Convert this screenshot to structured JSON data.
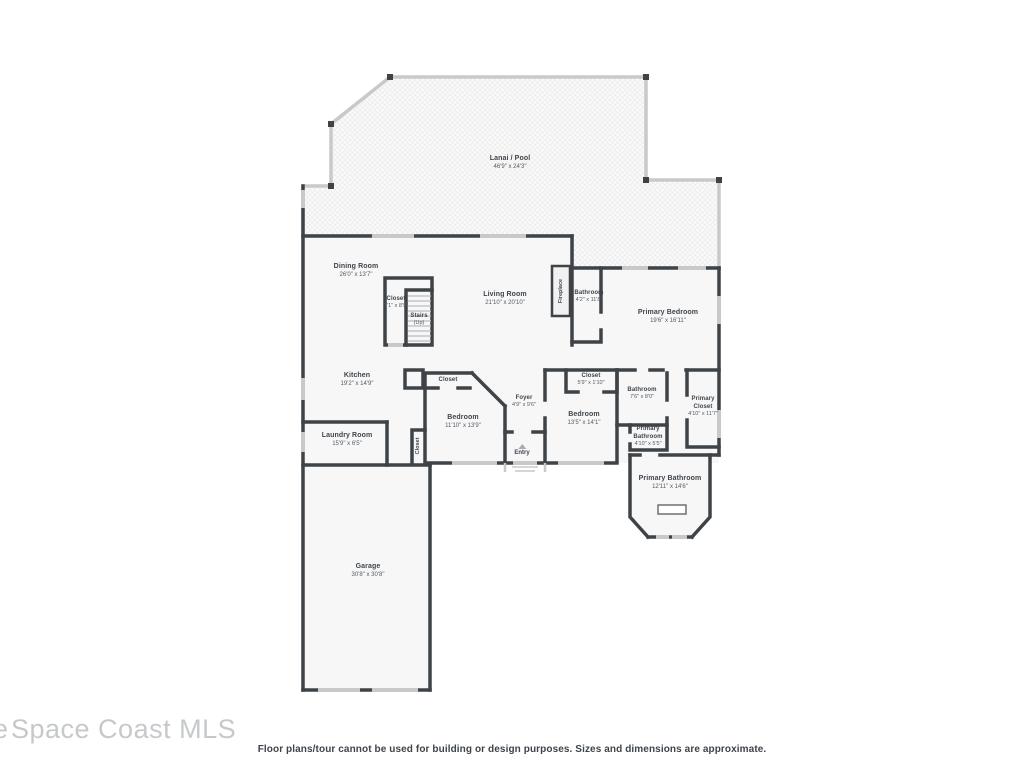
{
  "page": {
    "watermark": "Space Coast MLS",
    "watermark_partial": "e",
    "disclaimer": "Floor plans/tour cannot be used for building or design purposes. Sizes and dimensions are approximate."
  },
  "rooms": {
    "lanai": {
      "label": "Lanai / Pool",
      "dims": "46'9\" x 24'3\""
    },
    "dining": {
      "label": "Dining Room",
      "dims": "26'0\" x 13'7\""
    },
    "living": {
      "label": "Living Room",
      "dims": "21'10\" x 20'10\""
    },
    "closet_stairs": {
      "label": "Closet",
      "dims": "7'1\" x 8'9\""
    },
    "stairs": {
      "label": "Stairs",
      "dims": "(Up)"
    },
    "bath_top": {
      "label": "Bathroom",
      "dims": "4'2\" x 11'8\""
    },
    "primary_bedroom": {
      "label": "Primary Bedroom",
      "dims": "19'6\" x 16'11\""
    },
    "kitchen": {
      "label": "Kitchen",
      "dims": "19'2\" x 14'9\""
    },
    "laundry": {
      "label": "Laundry Room",
      "dims": "15'9\" x 6'5\""
    },
    "bedroom1": {
      "label": "Bedroom",
      "dims": "11'10\" x 13'9\""
    },
    "closet_bed1": {
      "label": "Closet"
    },
    "closet_vert": {
      "label": "Closet"
    },
    "foyer": {
      "label": "Foyer",
      "dims": "4'9\" x 9'6\""
    },
    "entry": {
      "label": "Entry"
    },
    "closet2": {
      "label": "Closet",
      "dims": "5'9\" x 1'10\""
    },
    "bedroom2": {
      "label": "Bedroom",
      "dims": "13'5\" x 14'1\""
    },
    "bathroom2": {
      "label": "Bathroom",
      "dims": "7'6\" x 8'0\""
    },
    "primary_bath_small": {
      "label": "Primary Bathroom",
      "dims": "4'10\" x 5'5\""
    },
    "primary_closet": {
      "label": "Primary Closet",
      "dims": "4'10\" x 11'7\""
    },
    "primary_bath": {
      "label": "Primary Bathroom",
      "dims": "12'11\" x 14'6\""
    },
    "garage": {
      "label": "Garage",
      "dims": "30'8\" x 30'8\""
    },
    "fireplace": {
      "label": "Fireplace"
    }
  },
  "colors": {
    "wall": "#3e4347",
    "window": "#c9c9c9",
    "room_fill": "#f7f7f8",
    "label_text": "#3f454b",
    "watermark": "#c6c9cb"
  }
}
